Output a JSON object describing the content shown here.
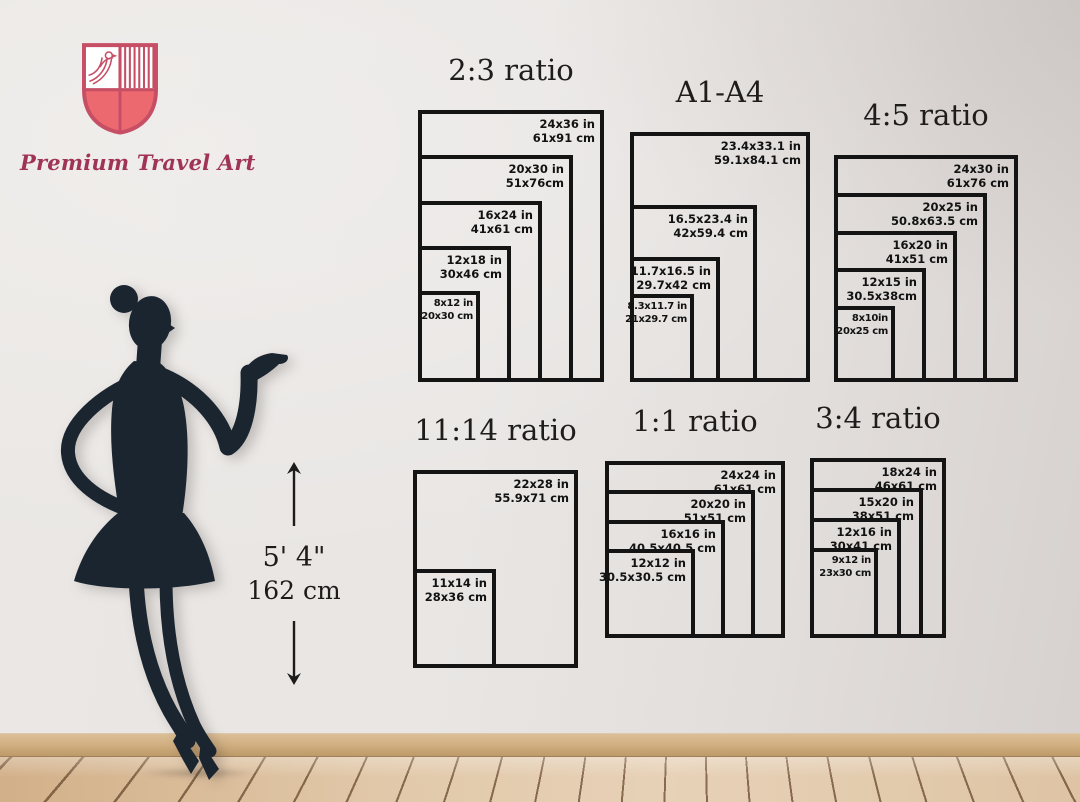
{
  "brand": {
    "name": "Premium Travel Art",
    "logo_icon": "shield-crest-with-bird-and-stripes"
  },
  "height_reference": {
    "imperial": "5' 4\"",
    "metric": "162 cm"
  },
  "groups": [
    {
      "id": "ratio-2-3",
      "title": "2:3 ratio",
      "sizes": [
        {
          "in": "24x36 in",
          "cm": "61x91 cm",
          "w": 24,
          "h": 36
        },
        {
          "in": "20x30 in",
          "cm": "51x76cm",
          "w": 20,
          "h": 30
        },
        {
          "in": "16x24 in",
          "cm": "41x61 cm",
          "w": 16,
          "h": 24
        },
        {
          "in": "12x18 in",
          "cm": "30x46 cm",
          "w": 12,
          "h": 18
        },
        {
          "in": "8x12 in",
          "cm": "20x30 cm",
          "w": 8,
          "h": 12
        }
      ]
    },
    {
      "id": "a1-a4",
      "title": "A1-A4",
      "sizes": [
        {
          "in": "23.4x33.1 in",
          "cm": "59.1x84.1 cm",
          "w": 23.4,
          "h": 33.1
        },
        {
          "in": "16.5x23.4 in",
          "cm": "42x59.4 cm",
          "w": 16.5,
          "h": 23.4
        },
        {
          "in": "11.7x16.5 in",
          "cm": "29.7x42 cm",
          "w": 11.7,
          "h": 16.5
        },
        {
          "in": "8.3x11.7 in",
          "cm": "21x29.7 cm",
          "w": 8.3,
          "h": 11.7
        }
      ]
    },
    {
      "id": "ratio-4-5",
      "title": "4:5 ratio",
      "sizes": [
        {
          "in": "24x30 in",
          "cm": "61x76 cm",
          "w": 24,
          "h": 30
        },
        {
          "in": "20x25 in",
          "cm": "50.8x63.5 cm",
          "w": 20,
          "h": 25
        },
        {
          "in": "16x20 in",
          "cm": "41x51 cm",
          "w": 16,
          "h": 20
        },
        {
          "in": "12x15 in",
          "cm": "30.5x38cm",
          "w": 12,
          "h": 15
        },
        {
          "in": "8x10in",
          "cm": "20x25 cm",
          "w": 8,
          "h": 10
        }
      ]
    },
    {
      "id": "ratio-11-14",
      "title": "11:14 ratio",
      "sizes": [
        {
          "in": "22x28 in",
          "cm": "55.9x71 cm",
          "w": 22,
          "h": 28
        },
        {
          "in": "11x14 in",
          "cm": "28x36 cm",
          "w": 11,
          "h": 14
        }
      ]
    },
    {
      "id": "ratio-1-1",
      "title": "1:1 ratio",
      "sizes": [
        {
          "in": "24x24 in",
          "cm": "61x61 cm",
          "w": 24,
          "h": 24
        },
        {
          "in": "20x20 in",
          "cm": "51x51 cm",
          "w": 20,
          "h": 20
        },
        {
          "in": "16x16 in",
          "cm": "40.5x40.5 cm",
          "w": 16,
          "h": 16
        },
        {
          "in": "12x12 in",
          "cm": "30.5x30.5 cm",
          "w": 12,
          "h": 12
        }
      ]
    },
    {
      "id": "ratio-3-4",
      "title": "3:4 ratio",
      "sizes": [
        {
          "in": "18x24 in",
          "cm": "46x61 cm",
          "w": 18,
          "h": 24
        },
        {
          "in": "15x20 in",
          "cm": "38x51 cm",
          "w": 15,
          "h": 20
        },
        {
          "in": "12x16 in",
          "cm": "30x41 cm",
          "w": 12,
          "h": 16
        },
        {
          "in": "9x12 in",
          "cm": "23x30 cm",
          "w": 9,
          "h": 12
        }
      ]
    }
  ],
  "colors": {
    "box_border": "#141414",
    "label_text": "#121212",
    "title_text": "#1e1d1c",
    "brand_text": "#a03458",
    "crest_line": "#c64f66",
    "crest_fill": "#ec6a6f",
    "silhouette": "#1b2530",
    "wall": "#e8e5e3",
    "floor_wood": "#ddc3a2",
    "baseboard": "#d0ad7e"
  }
}
